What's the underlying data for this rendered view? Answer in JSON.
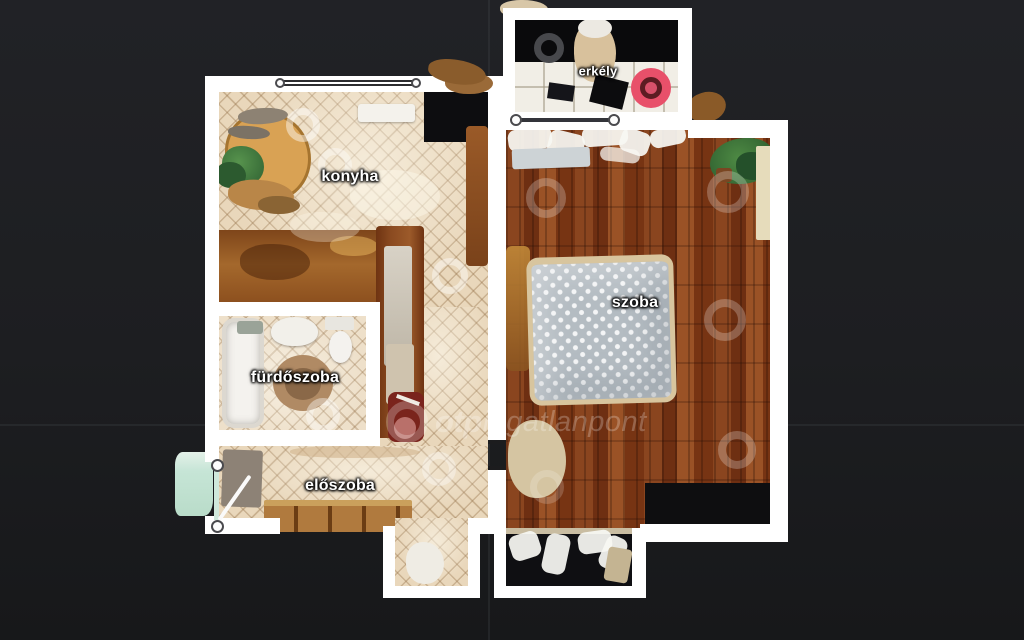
{
  "viewer": {
    "type": "3d-scan-floorplan-top-view",
    "background_color": "#1d1e21",
    "grid_line_color": "#505258"
  },
  "watermark": {
    "logo": "ring-icon",
    "bold_text": "otp",
    "light_text": "ingatlanpont",
    "color": "rgba(255,255,255,0.24)"
  },
  "floorplan": {
    "wall_color": "#ffffff",
    "rooms": [
      {
        "id": "erkely",
        "label": "erkély",
        "floor_style": "white-tile-balcony"
      },
      {
        "id": "konyha",
        "label": "konyha",
        "floor_style": "beige-diamond-tile"
      },
      {
        "id": "szoba",
        "label": "szoba",
        "floor_style": "redbrown-hardwood"
      },
      {
        "id": "furdoszoba",
        "label": "fürdőszoba",
        "floor_style": "beige-diamond-tile"
      },
      {
        "id": "eloszoba",
        "label": "előszoba",
        "floor_style": "beige-diamond-tile"
      }
    ],
    "markers": {
      "active_room": "erkély",
      "active_color": "#e8506a",
      "inactive_color": "#47484c",
      "sweep_color": "rgba(255,255,255,0.3)"
    }
  }
}
